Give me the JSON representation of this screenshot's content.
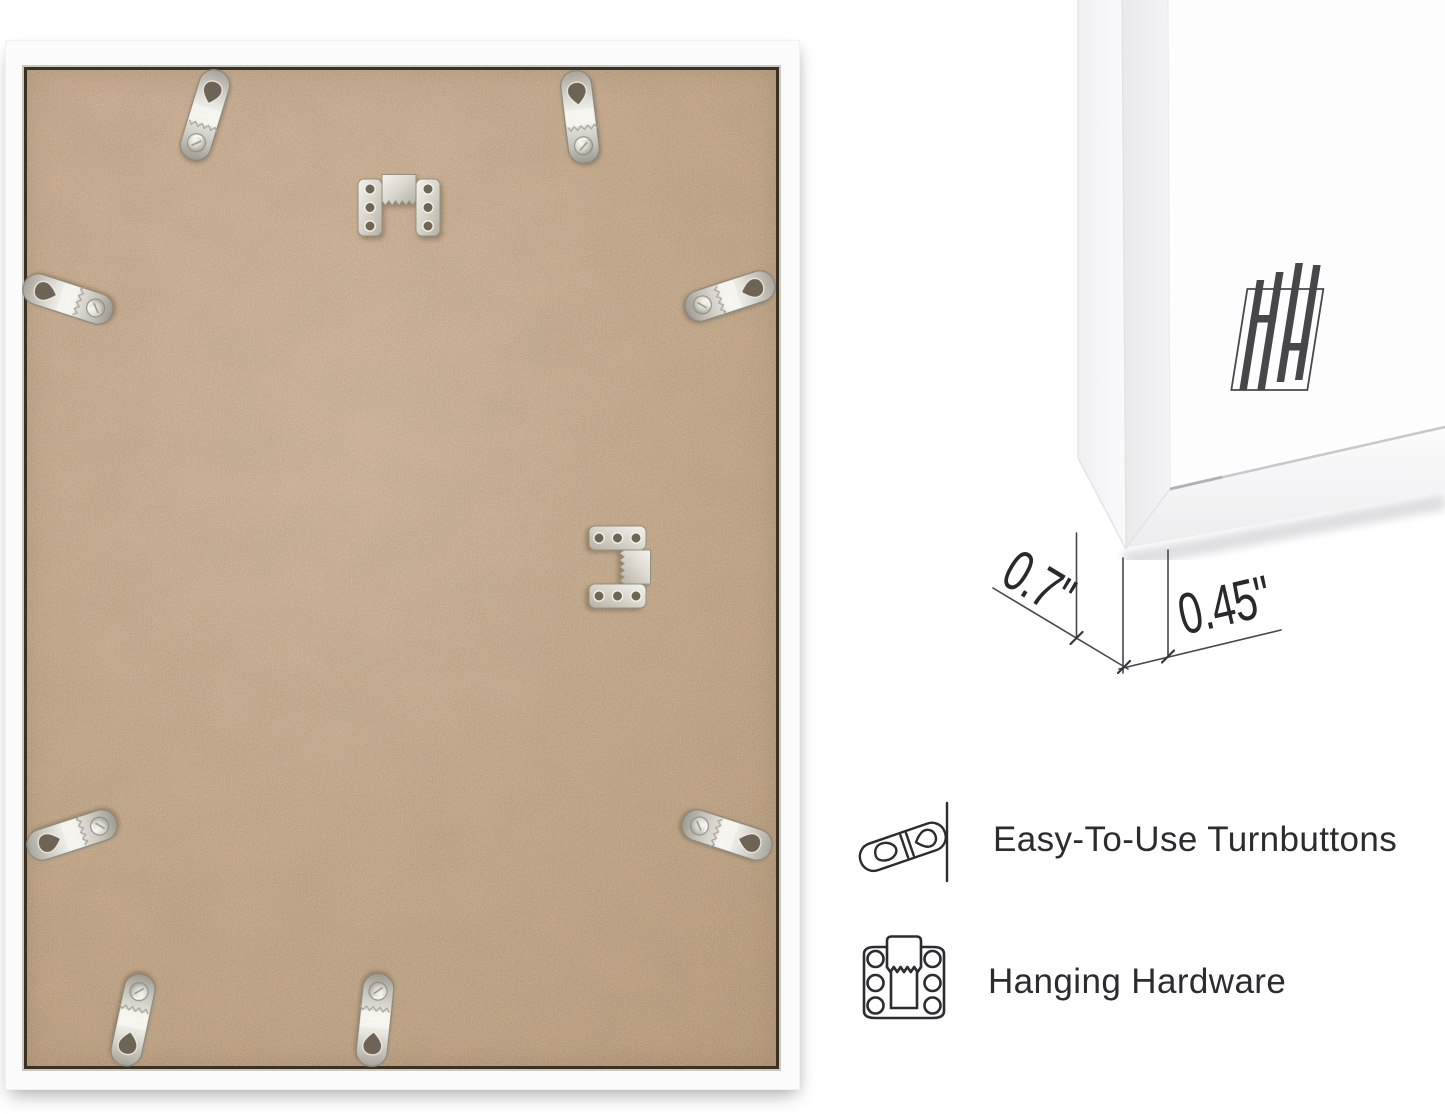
{
  "page": {
    "background": "#ffffff"
  },
  "back_photo": {
    "subject": "white picture frame seen from the back with kraft MDF backing board",
    "frame_color": "#fbfbfb",
    "board_color": "#c7a88b",
    "turnbutton_count": 8,
    "sawtooth_hanger_count": 2
  },
  "corner_photo": {
    "subject": "front corner of the white frame",
    "logo_icon": "hh-monogram-logo",
    "logo_color": "#47474b"
  },
  "dimensions": {
    "depth": "0.7\"",
    "face_width": "0.45\""
  },
  "features": [
    {
      "icon": "turnbutton-icon",
      "label": "Easy-To-Use Turnbuttons"
    },
    {
      "icon": "hanging-hardware-icon",
      "label": "Hanging Hardware"
    }
  ],
  "colors": {
    "text": "#2c2c2e",
    "dimension_lines": "#47474a",
    "metal_hardware": "#d6d3ca"
  }
}
